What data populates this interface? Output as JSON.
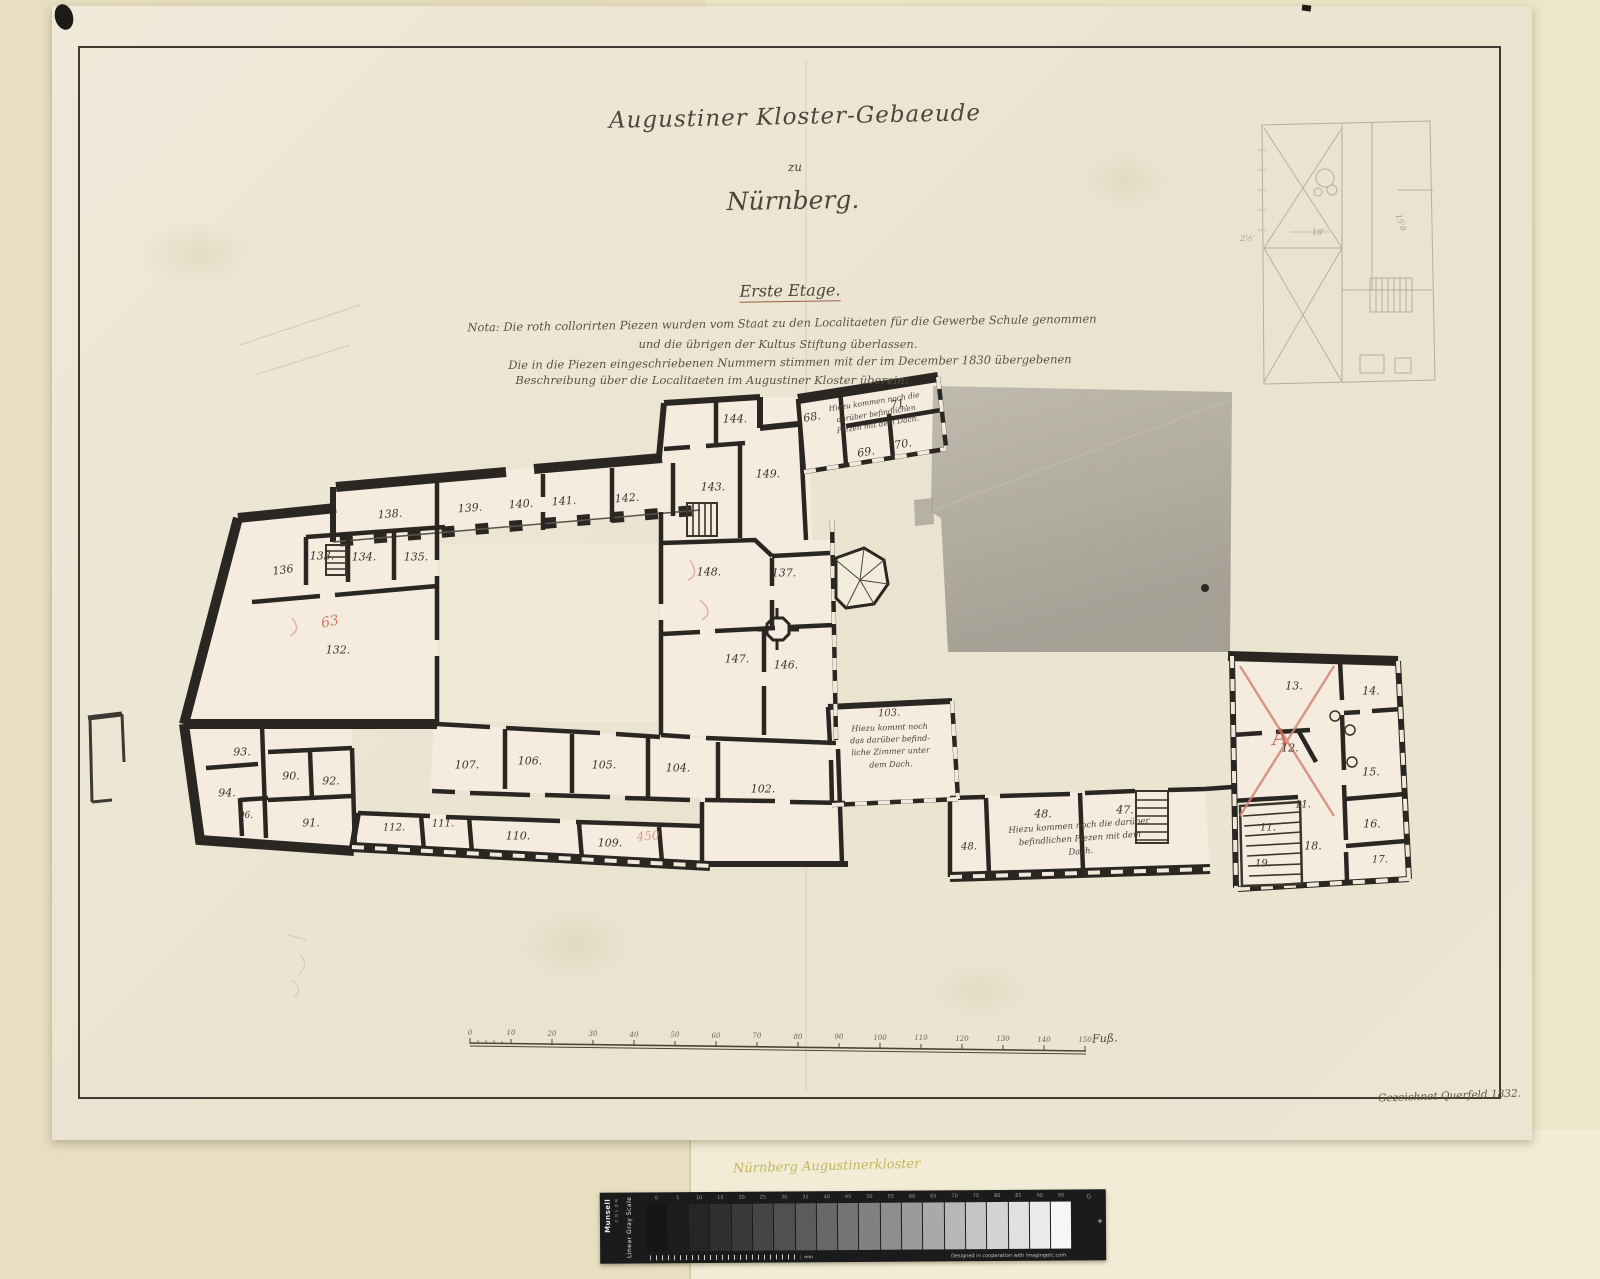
{
  "document": {
    "title_line1": "Augustiner Kloster-Gebaeude",
    "title_line2": "zu",
    "title_line3": "Nürnberg.",
    "floor_heading": "Erste Etage.",
    "nota_line1": "Nota: Die roth collorirten Piezen wurden vom Staat zu den Localitaeten für die Gewerbe Schule genommen",
    "nota_line2": "und die übrigen der Kultus Stiftung überlassen.",
    "nota_line3": "Die in die Piezen eingeschriebenen Nummern stimmen mit der im December 1830 übergebenen",
    "nota_line4": "Beschreibung über die Localitaeten im Augustiner Kloster überein:",
    "signature": "Gezeichnet Querfeld 1832.",
    "archive_note": "Nürnberg Augustinerkloster"
  },
  "plan": {
    "rooms": [
      "138.",
      "139.",
      "140.",
      "141.",
      "142.",
      "143.",
      "144.",
      "149.",
      "136",
      "133.",
      "134.",
      "135.",
      "132.",
      "148.",
      "137.",
      "147.",
      "146.",
      "68.",
      "69.",
      "70.",
      "71.",
      "93.",
      "94.",
      "90.",
      "92.",
      "96.",
      "91.",
      "107.",
      "106.",
      "105.",
      "104.",
      "112.",
      "111.",
      "110.",
      "109.",
      "102.",
      "48.",
      "47.",
      "48.",
      "13.",
      "14.",
      "12.",
      "15.",
      "11.",
      "11.",
      "16.",
      "18.",
      "17.",
      "19."
    ],
    "red_marks": {
      "mark_63": "63",
      "mark_a": "A",
      "mark_450": "450"
    },
    "note_68": {
      "line1": "Hiezu kommen noch die",
      "line2": "darüber befindlichen",
      "line3": "Piezen mit dem Dach."
    },
    "note_103": {
      "number": "103.",
      "line1": "Hiezu kommt noch",
      "line2": "das darüber befind-",
      "line3": "liche Zimmer unter",
      "line4": "dem Dach."
    },
    "note_47": {
      "line1": "Hiezu kommen noch die darüber",
      "line2": "befindlichen Piezen mit dem",
      "line3": "Dach."
    },
    "inset_labels": {
      "a": "18'",
      "b": "15'8",
      "c": "2½'"
    }
  },
  "scalebar": {
    "ticks": [
      "0",
      "10",
      "20",
      "30",
      "40",
      "50",
      "60",
      "70",
      "80",
      "90",
      "100",
      "110",
      "120",
      "130",
      "140",
      "150"
    ],
    "unit": "Fuß."
  },
  "munsell": {
    "brand": "Munsell",
    "brand_sub": "C O L O R",
    "scale_label": "Linear Gray Scale",
    "swatches": [
      "0",
      "5",
      "10",
      "15",
      "20",
      "25",
      "30",
      "35",
      "40",
      "45",
      "50",
      "55",
      "60",
      "65",
      "70",
      "75",
      "80",
      "85",
      "90",
      "95"
    ],
    "g_label": "G",
    "reg_mark": "+",
    "mm_label": "mm",
    "credit": "Designed in cooperation with imagingetc.com"
  }
}
